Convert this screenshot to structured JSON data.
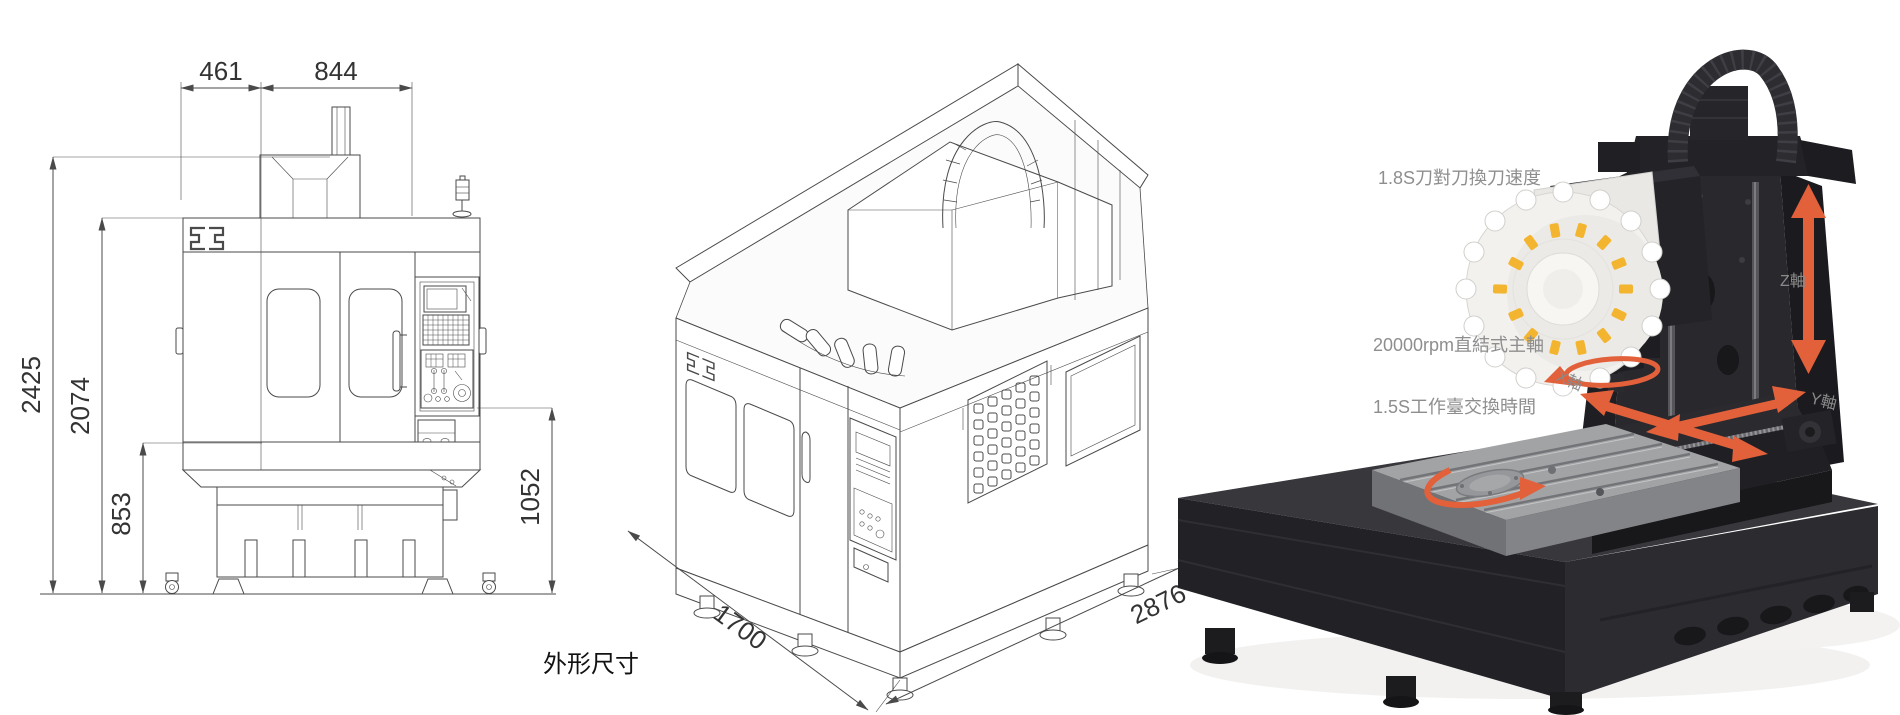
{
  "front_view": {
    "dim_top_left": "461",
    "dim_top_right": "844",
    "dim_height_total": "2425",
    "dim_height_body": "2074",
    "dim_height_base": "853",
    "dim_height_panel": "1052"
  },
  "iso_view": {
    "dim_depth": "1700",
    "dim_width": "2876",
    "caption": "外形尺寸"
  },
  "photo_view": {
    "label_tool_change": "1.8S刀對刀換刀速度",
    "label_spindle": "20000rpm直結式主軸",
    "label_pallet": "1.5S工作臺交換時間",
    "label_z_axis": "Z軸",
    "label_y_axis": "Y軸",
    "label_x_axis": "X軸"
  },
  "colors": {
    "arrow_orange": "#e2603a",
    "tag_yellow": "#f3b52f",
    "line_gray": "#4a4a4a",
    "annotation_gray": "#8e8e8e"
  }
}
